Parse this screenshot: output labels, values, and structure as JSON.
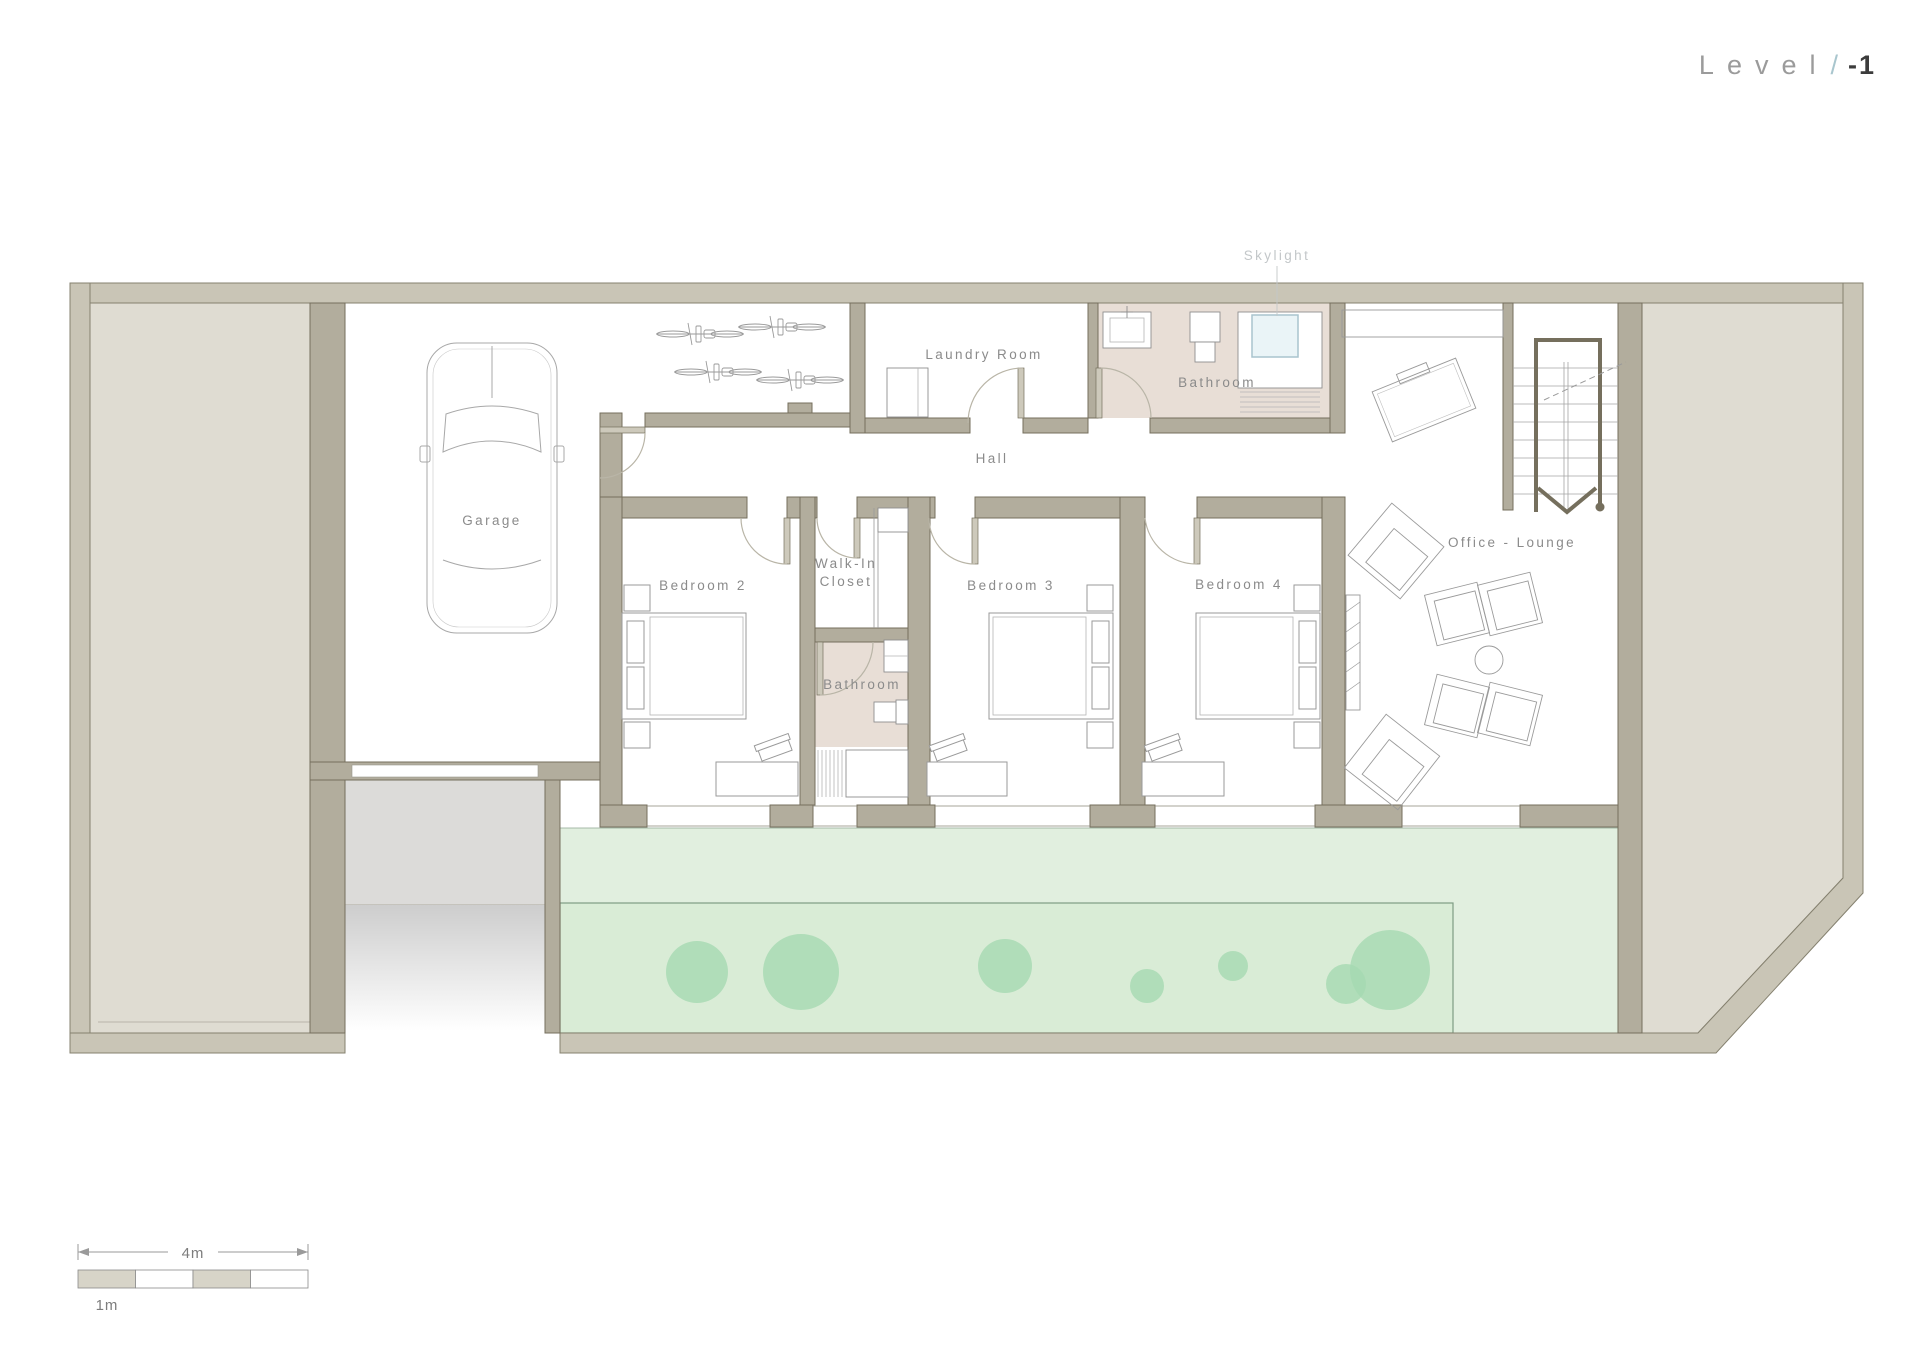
{
  "sheet": {
    "title_level": "Level",
    "title_separator": "/",
    "title_number": "-1"
  },
  "rooms": {
    "garage": "Garage",
    "laundry_room": "Laundry Room",
    "bathroom_upper": "Bathroom",
    "skylight": "Skylight",
    "hall": "Hall",
    "bedroom_2": "Bedroom 2",
    "walk_in_closet_line_1": "Walk-In",
    "walk_in_closet_line_2": "Closet",
    "bathroom_middle": "Bathroom",
    "bedroom_3": "Bedroom 3",
    "bedroom_4": "Bedroom 4",
    "office_lounge": "Office - Lounge"
  },
  "scale_bar": {
    "overall": "4m",
    "unit": "1m"
  },
  "colors": {
    "outer_wall_fill": "#c9c5b6",
    "outer_wall_stroke": "#85816f",
    "interior_wall_fill": "#b2ad9d",
    "interior_wall_stroke": "#756f5d",
    "solid_block_fill": "#dfdcd2",
    "bathroom_floor": "#e8ded6",
    "garden": "#e1efdf",
    "garden_inner": "#d9ecd6",
    "tree": "#a5d9b2",
    "skylight_fill": "#eaf4f7",
    "skylight_stroke": "#a9c4ce",
    "driveway": "#dcdbd9",
    "label_text": "#8b8b8b",
    "title_text": "#9b9b9b",
    "title_accent": "#a9c6ce",
    "title_number": "#3c3c3c"
  }
}
